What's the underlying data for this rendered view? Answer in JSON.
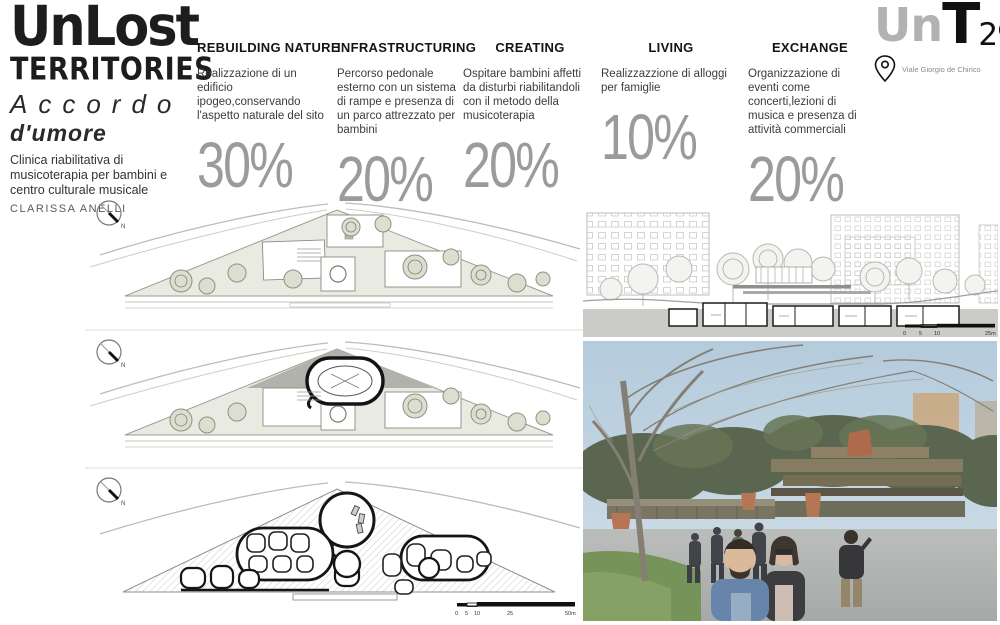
{
  "title": {
    "line1": "UnLost",
    "line2": "TERRITORIES",
    "subtitle1": "Accordo",
    "subtitle2": "d'umore",
    "description": "Clinica riabilitativa di musicoterapia per bambini e centro culturale musicale",
    "author": "CLARISSA ANELLI"
  },
  "logo": {
    "part1": "Un",
    "part2": "T",
    "part3": "29",
    "address": "Viale Giorgio de Chirico"
  },
  "columns": [
    {
      "header": "REBUILDING NATURE",
      "description": "Realizzazione di un edificio ipogeo,conservando l'aspetto naturale del sito",
      "percent": "30%"
    },
    {
      "header": "INFRASTRUCTURING",
      "description": "Percorso pedonale esterno con un sistema di rampe e presenza di un parco attrezzato per bambini",
      "percent": "20%"
    },
    {
      "header": "CREATING",
      "description": "Ospitare bambini affetti da disturbi riabilitandoli con il metodo della musicoterapia",
      "percent": "20%"
    },
    {
      "header": "LIVING",
      "description": "Realizzazzione di alloggi per famiglie",
      "percent": "10%"
    },
    {
      "header": "EXCHANGE",
      "description": "Organizzazione di eventi come concerti,lezioni di musica e presenza di attività commerciali",
      "percent": "20%"
    }
  ],
  "compass": {
    "label": "N"
  },
  "plan_scalebar": {
    "labels": [
      "0",
      "5",
      "10",
      "25",
      "50m"
    ]
  },
  "elevation_scalebar": {
    "labels": [
      "0",
      "5",
      "10",
      "25m"
    ]
  },
  "colors": {
    "percent_gray": "#9b9b9b",
    "logo_gray": "#b2b2b2",
    "accent_terracotta": "#a85f3d"
  }
}
